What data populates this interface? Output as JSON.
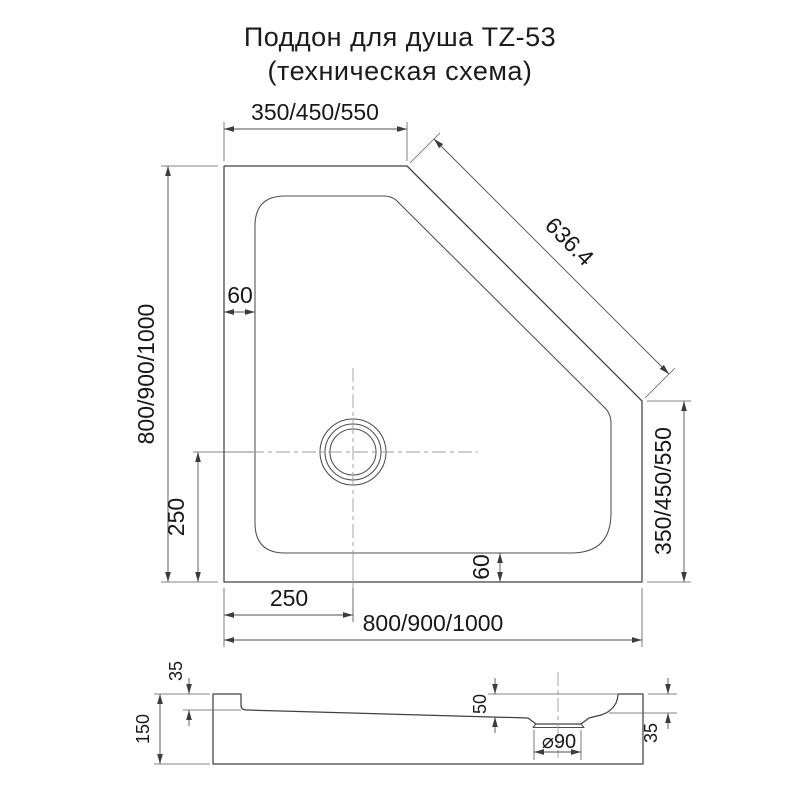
{
  "title": {
    "line1": "Поддон для душа TZ-53",
    "line2": "(техническая схема)"
  },
  "top_view": {
    "dim_top_width": "350/450/550",
    "dim_diagonal": "636.4",
    "dim_left_height": "800/900/1000",
    "dim_right_side": "350/450/550",
    "dim_rim_top_left": "60",
    "dim_rim_bottom": "60",
    "dim_drain_from_centerline": "250",
    "dim_drain_from_left": "250",
    "dim_bottom_width": "800/900/1000"
  },
  "section_view": {
    "dim_rim_height_left": "35",
    "dim_total_height": "150",
    "dim_depth_at_drain": "50",
    "dim_drain_diameter": "⌀90",
    "dim_rim_height_right": "35"
  }
}
